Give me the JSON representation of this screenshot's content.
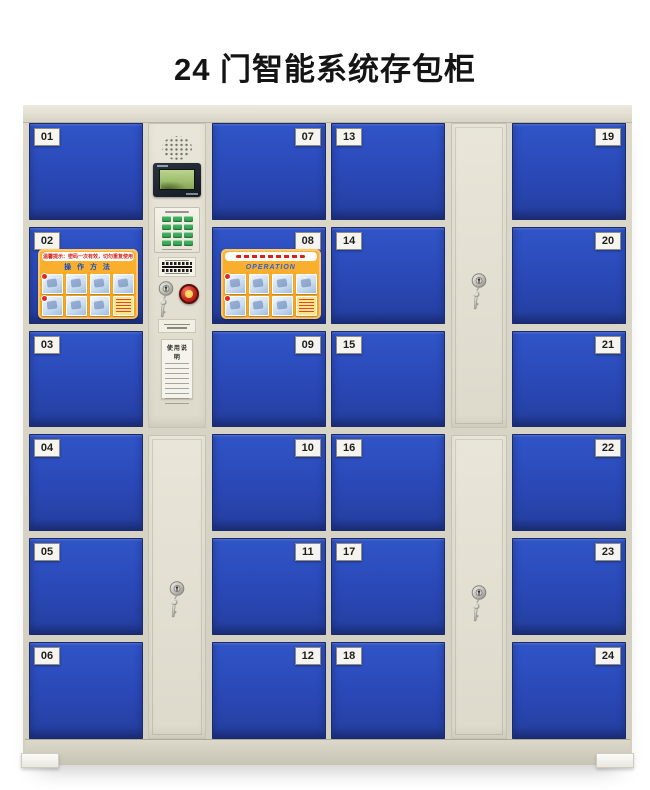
{
  "title": "24 门智能系统存包柜",
  "cabinet": {
    "door_columns": [
      {
        "label_side": "left",
        "doors": [
          {
            "number": "01"
          },
          {
            "number": "02",
            "sticker": "cn"
          },
          {
            "number": "03"
          },
          {
            "number": "04"
          },
          {
            "number": "05"
          },
          {
            "number": "06"
          }
        ]
      },
      {
        "label_side": "right",
        "doors": [
          {
            "number": "07"
          },
          {
            "number": "08",
            "sticker": "en"
          },
          {
            "number": "09"
          },
          {
            "number": "10"
          },
          {
            "number": "11"
          },
          {
            "number": "12"
          }
        ]
      },
      {
        "label_side": "left",
        "doors": [
          {
            "number": "13"
          },
          {
            "number": "14"
          },
          {
            "number": "15"
          },
          {
            "number": "16"
          },
          {
            "number": "17"
          },
          {
            "number": "18"
          }
        ]
      },
      {
        "label_side": "right",
        "doors": [
          {
            "number": "19"
          },
          {
            "number": "20"
          },
          {
            "number": "21"
          },
          {
            "number": "22"
          },
          {
            "number": "23"
          },
          {
            "number": "24"
          }
        ]
      }
    ],
    "stickers": {
      "cn": {
        "header": "温馨提示：密码一次有效，切勿重复使用",
        "title": "操 作 方 法"
      },
      "en": {
        "header": "",
        "title": "OPERATION"
      }
    },
    "control": {
      "instruction_title": "使用说明"
    },
    "colors": {
      "door_blue": "#2a48b6",
      "frame_cream": "#dcd9cb",
      "sticker_orange": "#f8a41f",
      "accent_red": "#c7271f",
      "lcd_green": "#9dbd6c",
      "keypad_green": "#2f9e4e"
    }
  }
}
